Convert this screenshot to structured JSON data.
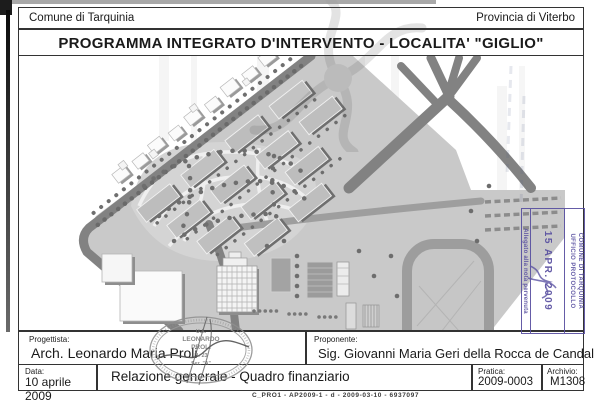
{
  "header": {
    "left": "Comune di Tarquinia",
    "right": "Provincia di Viterbo"
  },
  "title": "PROGRAMMA INTEGRATO D'INTERVENTO  - LOCALITA' \"GIGLIO\"",
  "protocol_stamp": {
    "office_line1": "COMUNE DI TARQUINIA",
    "office_line2": "UFFICIO PROTOCOLLO",
    "date": "15 APR. 2009",
    "side_note": "Allegato alla nota pervenuta",
    "ink_color": "#584fa0"
  },
  "architect_stamp": {
    "center_lines": [
      "U.A.",
      "LEONARDO",
      "PROLI",
      "N. 23",
      "Sez. \"A\""
    ]
  },
  "info_table": {
    "progettista_label": "Progettista:",
    "progettista_value": "Arch. Leonardo Maria Proli",
    "proponente_label": "Proponente:",
    "proponente_value": "Sig. Giovanni Maria Geri della Rocca de Candal",
    "data_label": "Data:",
    "data_value": "10 aprile 2009",
    "oggetto": "Relazione generale - Quadro finanziario",
    "pratica_label": "Pratica:",
    "pratica_value": "2009-0003",
    "archivio_label": "Archivio:",
    "archivio_value": "M1308"
  },
  "footer_code": "C_PRO1 - AP2009-1 - d - 2009-03-10 - 6937097",
  "colors": {
    "border": "#333333",
    "stamp_ink": "#584fa0",
    "road": "#828282",
    "ground": "#c9c9c9"
  }
}
